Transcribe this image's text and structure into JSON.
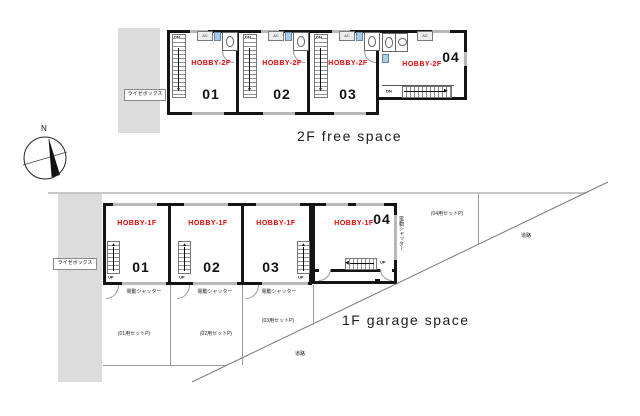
{
  "titles": {
    "floor2": "2F  free space",
    "floor1": "1F  garage space"
  },
  "labels": {
    "raise_box": "ライゼボックス",
    "north": "N",
    "road": "道路",
    "shutter": "電動シャッター",
    "dn": "DN",
    "up": "UP",
    "ac": "AC"
  },
  "floor2": {
    "units": [
      {
        "name": "HOBBY-2F",
        "number": "01"
      },
      {
        "name": "HOBBY-2F",
        "number": "02"
      },
      {
        "name": "HOBBY-2F",
        "number": "03"
      },
      {
        "name": "HOBBY-2F",
        "number": "04"
      }
    ]
  },
  "floor1": {
    "units": [
      {
        "name": "HOBBY-1F",
        "number": "01"
      },
      {
        "name": "HOBBY-1F",
        "number": "02"
      },
      {
        "name": "HOBBY-1F",
        "number": "03"
      },
      {
        "name": "HOBBY-1F",
        "number": "04"
      }
    ],
    "parking": [
      {
        "label": "(01用セットP)"
      },
      {
        "label": "(02用セットP)"
      },
      {
        "label": "(03用セットP)"
      },
      {
        "label": "(04用セットP)"
      }
    ]
  },
  "colors": {
    "accent": "#e60000",
    "graybox": "#dcdcdc",
    "wall": "#141414",
    "line": "#777777"
  }
}
